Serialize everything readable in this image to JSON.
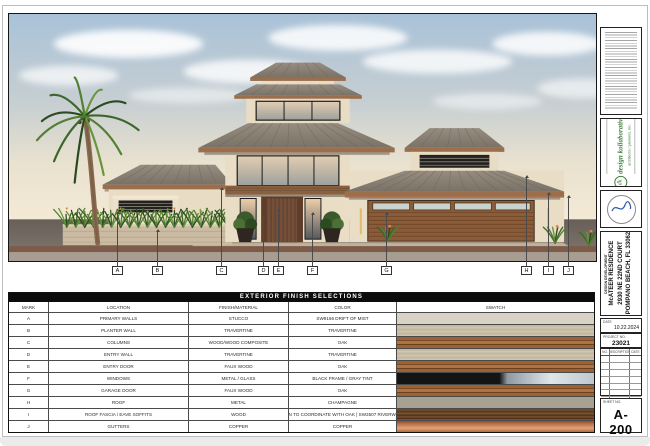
{
  "sheet": {
    "finish_table": {
      "title": "EXTERIOR FINISH SELECTIONS",
      "columns": [
        "MARK",
        "LOCATION",
        "FINISH/MATERIAL",
        "COLOR",
        "SWATCH"
      ],
      "rows": [
        {
          "mark": "A",
          "location": "PRIMARY WALLS",
          "finish": "STUCCO",
          "color": "SW9166 DRIFT OF MIST",
          "swatch": "stucco"
        },
        {
          "mark": "B",
          "location": "PLANTER WALL",
          "finish": "TRAVERTINE",
          "color": "TRAVERTINE",
          "swatch": "travertine"
        },
        {
          "mark": "C",
          "location": "COLUMNS",
          "finish": "WOOD/WOOD COMPOSITE",
          "color": "OAK",
          "swatch": "oak"
        },
        {
          "mark": "D",
          "location": "ENTRY WALL",
          "finish": "TRAVERTINE",
          "color": "TRAVERTINE",
          "swatch": "travertine"
        },
        {
          "mark": "E",
          "location": "ENTRY DOOR",
          "finish": "FAUX WOOD",
          "color": "OAK",
          "swatch": "oak"
        },
        {
          "mark": "F",
          "location": "WINDOWS",
          "finish": "METAL / GLASS",
          "color": "BLACK FRAME / GRAY TINT",
          "swatch": "glass"
        },
        {
          "mark": "G",
          "location": "GARAGE DOOR",
          "finish": "FAUX WOOD",
          "color": "OAK",
          "swatch": "oak"
        },
        {
          "mark": "H",
          "location": "ROOF",
          "finish": "METAL",
          "color": "CHAMPAGNE",
          "swatch": "champagne"
        },
        {
          "mark": "I",
          "location": "ROOF FASCIA / EAVE SOFFITS",
          "finish": "WOOD",
          "color": "STAIN TO COORDINATE WITH OAK | SW3507 RIVERWOOD",
          "swatch": "riverwood"
        },
        {
          "mark": "J",
          "location": "GUTTERS",
          "finish": "COPPER",
          "color": "COPPER",
          "swatch": "copper"
        }
      ]
    },
    "callouts": [
      {
        "letter": "A",
        "x": 117,
        "tip_y": 212
      },
      {
        "letter": "B",
        "x": 157,
        "tip_y": 230
      },
      {
        "letter": "C",
        "x": 221,
        "tip_y": 188
      },
      {
        "letter": "D",
        "x": 263,
        "tip_y": 216
      },
      {
        "letter": "E",
        "x": 278,
        "tip_y": 209
      },
      {
        "letter": "F",
        "x": 312,
        "tip_y": 213
      },
      {
        "letter": "G",
        "x": 386,
        "tip_y": 213
      },
      {
        "letter": "H",
        "x": 526,
        "tip_y": 176
      },
      {
        "letter": "I",
        "x": 548,
        "tip_y": 193
      },
      {
        "letter": "J",
        "x": 568,
        "tip_y": 196
      }
    ],
    "titleblock": {
      "firm_name": "design kollaborative",
      "firm_sub": "architects / planners, inc.",
      "firm_glyph": "dk",
      "phase": "DESIGN DEVELOPMENT",
      "project_name": "McATEER RESIDENCE",
      "project_address1": "2930 NE 22ND COURT",
      "project_address2": "POMPANO BEACH, FL 33062",
      "date_label": "DATE",
      "date": "10.22.2024",
      "project_no_label": "PROJECT NO.",
      "project_no": "23021",
      "rev_headers": [
        "NO.",
        "DESCRIPTION",
        "DATE"
      ],
      "sheet_no_label": "SHEET NO.",
      "sheet_no": "A-200"
    },
    "palette": {
      "roof_metal": "#8b8177",
      "wall_stucco": "#e9ddc5",
      "wood_fascia": "#9b6f4b",
      "firm_green": "#3f7d3b",
      "table_header_bg": "#0c0c0c",
      "copper": "#b06640"
    }
  }
}
